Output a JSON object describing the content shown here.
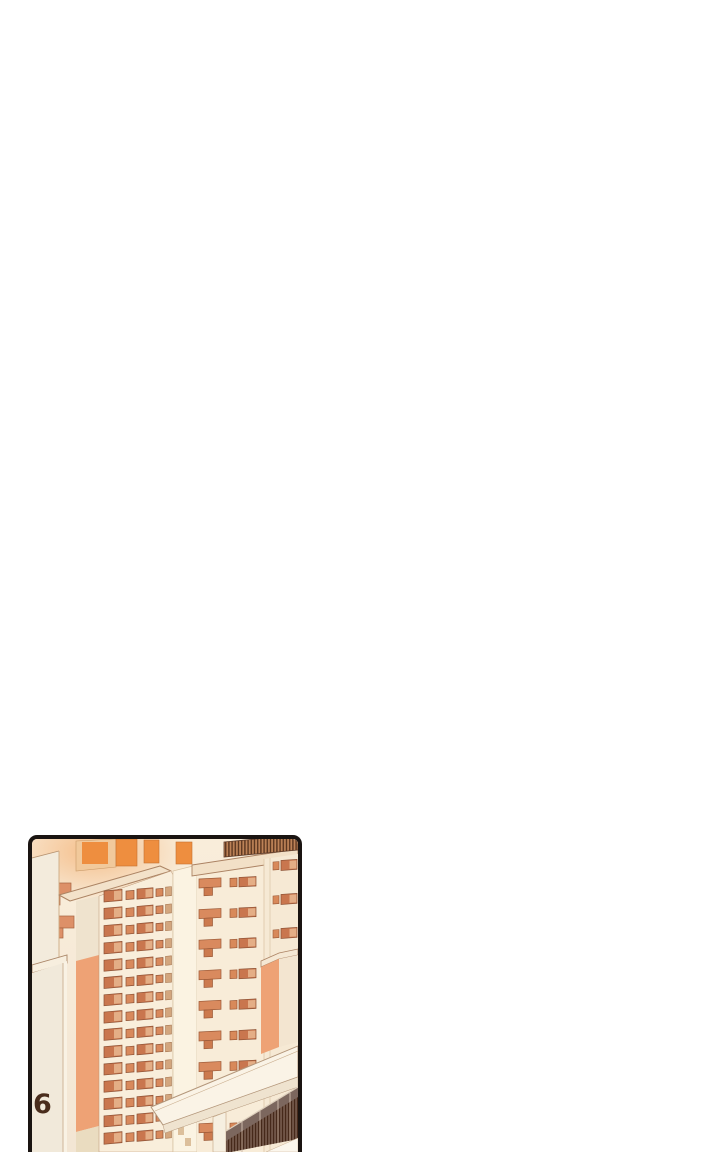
{
  "panel": {
    "page_number": "6",
    "scene": "Sunset cityscape of high-rise apartment towers viewed from above",
    "position": "bottom-left of an otherwise blank white page"
  },
  "colors": {
    "page_background": "#ffffff",
    "panel_border": "#1a1411",
    "sky_cream": "#f9edda",
    "bright_window": "#ee8e3f",
    "window_orange": "#c9764e",
    "window_pane_light": "#e4ae86",
    "salmon_wall": "#eea275",
    "railing_dark": "#59351f",
    "glass_band": "#7c675e",
    "numeral": "#4a2d1c"
  }
}
